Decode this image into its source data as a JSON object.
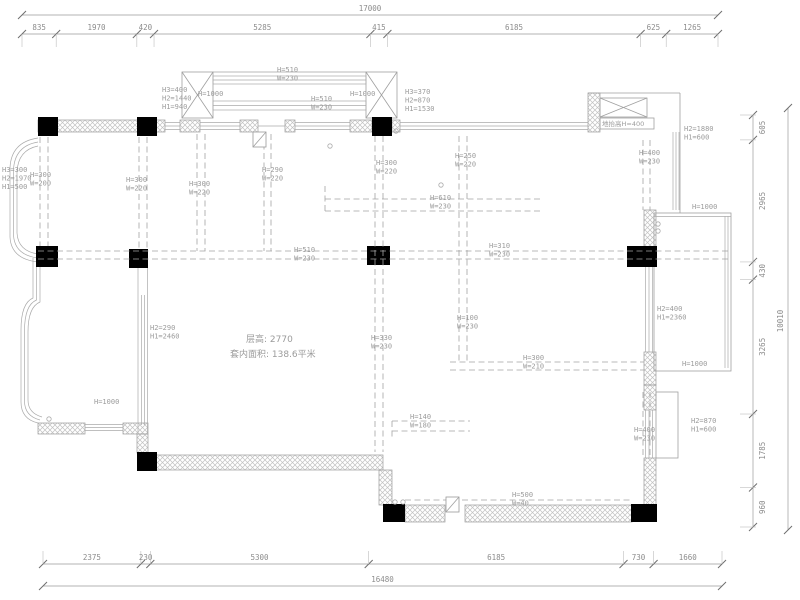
{
  "plan": {
    "floor_info": {
      "line1": "层高: 2770",
      "line2": "套内面积: 138.6平米"
    },
    "dimensions": {
      "top": {
        "total_label": "17000",
        "total": 17000,
        "segments": [
          835,
          1970,
          420,
          5285,
          415,
          6185,
          625,
          1265
        ]
      },
      "bottom": {
        "total_label": "16480",
        "total": 16480,
        "segments": [
          2375,
          230,
          5300,
          6185,
          730,
          1660
        ]
      },
      "right": {
        "total_label": "10010",
        "total": 10010,
        "segments": [
          605,
          2965,
          430,
          3265,
          1785,
          960
        ]
      }
    },
    "annotations": [
      {
        "lines": [
          "H3=300",
          "H2=1970",
          "H1=500"
        ],
        "x": 2,
        "y": 172
      },
      {
        "lines": [
          "H=300",
          "W=200"
        ],
        "x": 30,
        "y": 177
      },
      {
        "lines": [
          "H=300",
          "W=220"
        ],
        "x": 126,
        "y": 182
      },
      {
        "lines": [
          "H=300",
          "W=220"
        ],
        "x": 189,
        "y": 186
      },
      {
        "lines": [
          "H=290",
          "W=220"
        ],
        "x": 262,
        "y": 172
      },
      {
        "lines": [
          "H=300",
          "W=220"
        ],
        "x": 376,
        "y": 165
      },
      {
        "lines": [
          "H=250",
          "W=220"
        ],
        "x": 455,
        "y": 158
      },
      {
        "lines": [
          "H=610",
          "W=230"
        ],
        "x": 430,
        "y": 200
      },
      {
        "lines": [
          "H=510",
          "W=230"
        ],
        "x": 294,
        "y": 252
      },
      {
        "lines": [
          "H=310",
          "W=230"
        ],
        "x": 489,
        "y": 248
      },
      {
        "lines": [
          "H3=400",
          "H2=1440",
          "H1=940"
        ],
        "x": 162,
        "y": 92
      },
      {
        "lines": [
          "H=1000"
        ],
        "x": 198,
        "y": 96
      },
      {
        "lines": [
          "H=510",
          "W=230"
        ],
        "x": 277,
        "y": 72
      },
      {
        "lines": [
          "H=510",
          "W=230"
        ],
        "x": 311,
        "y": 101
      },
      {
        "lines": [
          "H=1000"
        ],
        "x": 350,
        "y": 96
      },
      {
        "lines": [
          "H3=370",
          "H2=870",
          "H1=1530"
        ],
        "x": 405,
        "y": 94
      },
      {
        "lines": [
          "地抬高H=400"
        ],
        "x": 602,
        "y": 126,
        "cn": true,
        "size": 6.5
      },
      {
        "lines": [
          "H2=1880",
          "H1=600"
        ],
        "x": 684,
        "y": 131
      },
      {
        "lines": [
          "H=400",
          "W=230"
        ],
        "x": 639,
        "y": 155
      },
      {
        "lines": [
          "H=1000"
        ],
        "x": 692,
        "y": 209
      },
      {
        "lines": [
          "H2=400",
          "H1=2360"
        ],
        "x": 657,
        "y": 311
      },
      {
        "lines": [
          "H=1000"
        ],
        "x": 682,
        "y": 366
      },
      {
        "lines": [
          "H2=870",
          "H1=600"
        ],
        "x": 691,
        "y": 423
      },
      {
        "lines": [
          "H=400",
          "W=230"
        ],
        "x": 634,
        "y": 432
      },
      {
        "lines": [
          "H2=290",
          "H1=2460"
        ],
        "x": 150,
        "y": 330
      },
      {
        "lines": [
          "层高: 2770"
        ],
        "x": 246,
        "y": 342,
        "cn": true,
        "size": 9
      },
      {
        "lines": [
          "套内面积: 138.6平米"
        ],
        "x": 230,
        "y": 357,
        "cn": true,
        "size": 9
      },
      {
        "lines": [
          "H=330",
          "W=230"
        ],
        "x": 371,
        "y": 340
      },
      {
        "lines": [
          "H=100",
          "W=230"
        ],
        "x": 457,
        "y": 320
      },
      {
        "lines": [
          "H=300",
          "W=210"
        ],
        "x": 523,
        "y": 360
      },
      {
        "lines": [
          "H=140",
          "W=180"
        ],
        "x": 410,
        "y": 419
      },
      {
        "lines": [
          "H=500",
          "W=40"
        ],
        "x": 512,
        "y": 497
      },
      {
        "lines": [
          "H=1000"
        ],
        "x": 94,
        "y": 404
      }
    ]
  }
}
